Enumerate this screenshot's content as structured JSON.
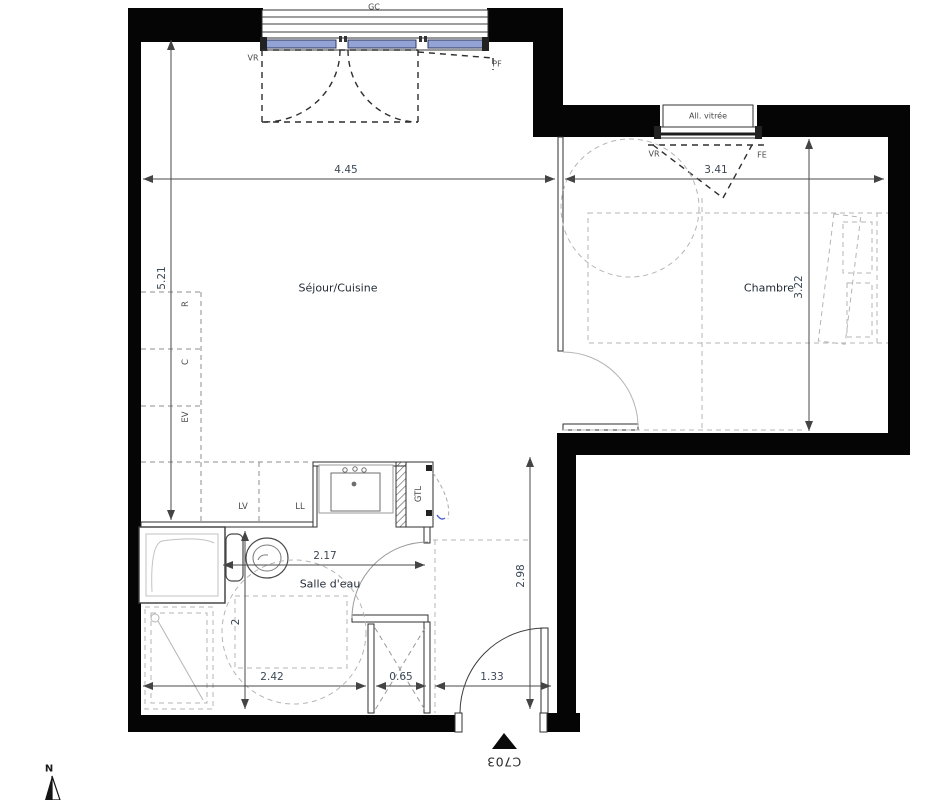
{
  "plan": {
    "code": "C703",
    "north_label": "N",
    "rooms": [
      {
        "name": "Séjour/Cuisine"
      },
      {
        "name": "Chambre"
      },
      {
        "name": "Salle d'eau"
      }
    ],
    "annotations": {
      "gc": "GC",
      "vr_sejour": "VR",
      "pf": "PF",
      "all_vitree": "All. vitrée",
      "vr_chambre": "VR",
      "fe": "FE",
      "refrigerator": "R",
      "cooktop": "C",
      "sink_ev": "EV",
      "dishwasher": "LV",
      "washer": "LL",
      "gtl": "GTL"
    },
    "dimensions": {
      "sejour_width": "4.45",
      "chambre_width": "3.41",
      "sejour_depth": "5.21",
      "chambre_depth": "3.22",
      "sde_width": "2.17",
      "hall_depth": "2.98",
      "sde_depth": "2",
      "sde_bottom_width": "2.42",
      "closet_width": "0.65",
      "entry_width": "1.33"
    },
    "colors": {
      "wall": "#050505",
      "glazing_blue": "#94a3d6",
      "dashed_light": "#b5b5b5",
      "dim_text": "#3b4856"
    }
  }
}
